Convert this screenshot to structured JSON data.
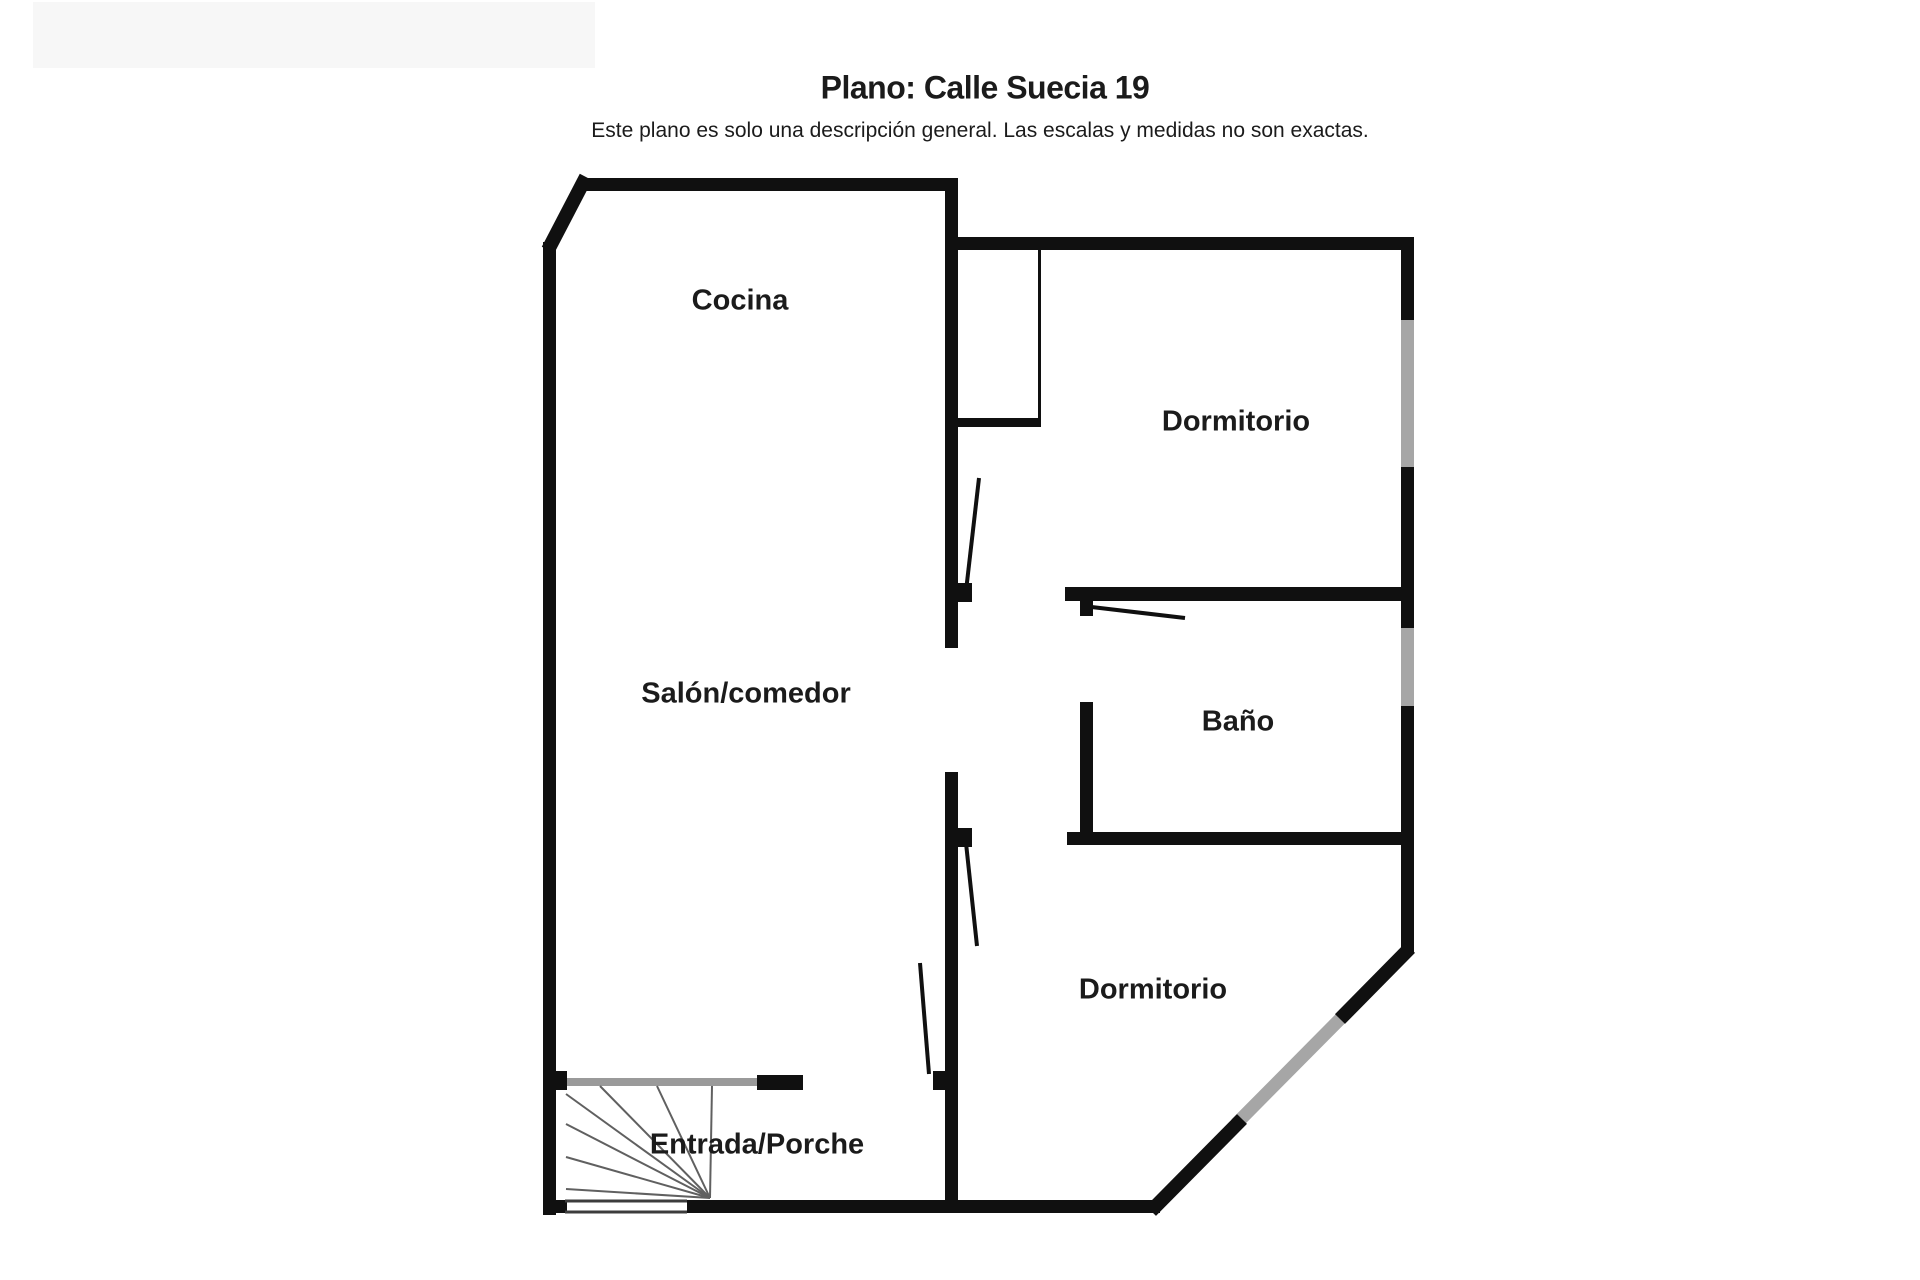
{
  "header": {
    "title": "Plano: Calle Suecia 19",
    "subtitle": "Este plano es solo una descripción general. Las escalas y medidas no son exactas.",
    "panel": {
      "x": 33,
      "y": 2,
      "w": 562,
      "h": 66
    }
  },
  "colors": {
    "wall": "#101010",
    "window": "#a6a6a6",
    "rail": "#9a9a9a",
    "sill": "#3c3c3c",
    "stair": "#606060",
    "panel": "#f7f7f7",
    "text": "#1b1b1b",
    "background": "#ffffff"
  },
  "rooms": [
    {
      "id": "cocina",
      "label": "Cocina",
      "x": 740,
      "y": 301
    },
    {
      "id": "salon-comedor",
      "label": "Salón/comedor",
      "x": 746,
      "y": 694
    },
    {
      "id": "dormitorio-1",
      "label": "Dormitorio",
      "x": 1236,
      "y": 422
    },
    {
      "id": "bano",
      "label": "Baño",
      "x": 1238,
      "y": 722
    },
    {
      "id": "dormitorio-2",
      "label": "Dormitorio",
      "x": 1153,
      "y": 990
    },
    {
      "id": "entrada-porche",
      "label": "Entrada/Porche",
      "x": 757,
      "y": 1145
    }
  ],
  "floorplan": {
    "width": 1920,
    "height": 1280,
    "rects": [
      {
        "name": "top-wall",
        "x": 580,
        "y": 178,
        "w": 378,
        "h": 13,
        "c": "wall"
      },
      {
        "name": "left-wall",
        "x": 543,
        "y": 242,
        "w": 13,
        "h": 973,
        "c": "wall"
      },
      {
        "name": "bottom-wall-left-corner",
        "x": 543,
        "y": 1200,
        "w": 24,
        "h": 13,
        "c": "wall"
      },
      {
        "name": "bottom-wall",
        "x": 687,
        "y": 1200,
        "w": 473,
        "h": 13,
        "c": "wall"
      },
      {
        "name": "right-wall-window-dormitorio1",
        "x": 1401,
        "y": 320,
        "w": 13,
        "h": 147,
        "c": "window"
      },
      {
        "name": "right-wall-window-bano",
        "x": 1401,
        "y": 628,
        "w": 13,
        "h": 78,
        "c": "window"
      },
      {
        "name": "right-wall-top",
        "x": 1401,
        "y": 240,
        "w": 13,
        "h": 80,
        "c": "wall"
      },
      {
        "name": "right-wall-mid",
        "x": 1401,
        "y": 467,
        "w": 13,
        "h": 161,
        "c": "wall"
      },
      {
        "name": "right-wall-bottom",
        "x": 1401,
        "y": 706,
        "w": 13,
        "h": 247,
        "c": "wall"
      },
      {
        "name": "dormitorio1-top-wall",
        "x": 945,
        "y": 237,
        "w": 469,
        "h": 13,
        "c": "wall"
      },
      {
        "name": "central-wall-upper",
        "x": 945,
        "y": 178,
        "w": 13,
        "h": 470,
        "c": "wall"
      },
      {
        "name": "central-wall-lower",
        "x": 945,
        "y": 772,
        "w": 13,
        "h": 441,
        "c": "wall"
      },
      {
        "name": "bano-top-wall",
        "x": 1065,
        "y": 587,
        "w": 349,
        "h": 14,
        "c": "wall"
      },
      {
        "name": "bano-left-wall",
        "x": 1080,
        "y": 702,
        "w": 13,
        "h": 143,
        "c": "wall"
      },
      {
        "name": "bano-bottom-wall",
        "x": 1067,
        "y": 832,
        "w": 347,
        "h": 13,
        "c": "wall"
      },
      {
        "name": "closet-bottom-wall",
        "x": 955,
        "y": 418,
        "w": 86,
        "h": 9,
        "c": "wall"
      },
      {
        "name": "closet-right-wall",
        "x": 1038,
        "y": 250,
        "w": 3,
        "h": 170,
        "c": "wall"
      },
      {
        "name": "porch-rail",
        "x": 563,
        "y": 1078,
        "w": 194,
        "h": 8,
        "c": "rail"
      },
      {
        "name": "porch-wall-segment",
        "x": 757,
        "y": 1075,
        "w": 46,
        "h": 15,
        "c": "wall"
      },
      {
        "name": "porch-rail-left-post",
        "x": 552,
        "y": 1071,
        "w": 15,
        "h": 19,
        "c": "wall"
      },
      {
        "name": "door-hinge-dormitorio1",
        "x": 958,
        "y": 583,
        "w": 14,
        "h": 19,
        "c": "wall"
      },
      {
        "name": "door-hinge-bano",
        "x": 1080,
        "y": 601,
        "w": 13,
        "h": 15,
        "c": "wall"
      },
      {
        "name": "door-hinge-dormitorio2",
        "x": 958,
        "y": 828,
        "w": 14,
        "h": 19,
        "c": "wall"
      },
      {
        "name": "door-hinge-entrance",
        "x": 933,
        "y": 1071,
        "w": 14,
        "h": 19,
        "c": "wall"
      }
    ],
    "lines": [
      {
        "name": "chamfer-wall",
        "x1": 586,
        "y1": 177,
        "x2": 548,
        "y2": 250,
        "w": 14,
        "c": "wall"
      },
      {
        "name": "diagonal-window",
        "x1": 1236,
        "y1": 1124,
        "x2": 1346,
        "y2": 1013,
        "w": 13,
        "c": "window"
      },
      {
        "name": "diagonal-wall-lower",
        "x1": 1151,
        "y1": 1211,
        "x2": 1242,
        "y2": 1119,
        "w": 14,
        "c": "wall"
      },
      {
        "name": "diagonal-wall-upper",
        "x1": 1340,
        "y1": 1019,
        "x2": 1410,
        "y2": 948,
        "w": 14,
        "c": "wall"
      },
      {
        "name": "entrance-opening-outer-line",
        "x1": 565,
        "y1": 1201,
        "x2": 687,
        "y2": 1201,
        "w": 3,
        "c": "sill"
      },
      {
        "name": "entrance-opening-inner-line",
        "x1": 565,
        "y1": 1212,
        "x2": 687,
        "y2": 1212,
        "w": 3,
        "c": "sill"
      },
      {
        "name": "door-leaf-dormitorio1",
        "x1": 966,
        "y1": 591,
        "x2": 979,
        "y2": 478,
        "w": 4,
        "c": "wall"
      },
      {
        "name": "door-leaf-bano",
        "x1": 1083,
        "y1": 606,
        "x2": 1185,
        "y2": 618,
        "w": 4,
        "c": "wall"
      },
      {
        "name": "door-leaf-dormitorio2",
        "x1": 966,
        "y1": 843,
        "x2": 977,
        "y2": 946,
        "w": 4,
        "c": "wall"
      },
      {
        "name": "door-leaf-entrance",
        "x1": 929,
        "y1": 1074,
        "x2": 920,
        "y2": 963,
        "w": 4,
        "c": "wall"
      }
    ],
    "stairs": {
      "apex": [
        710,
        1198
      ],
      "w": 2,
      "c": "stair",
      "targets": [
        [
          566,
          1094
        ],
        [
          566,
          1124
        ],
        [
          566,
          1157
        ],
        [
          566,
          1189
        ],
        [
          600,
          1086
        ],
        [
          657,
          1086
        ],
        [
          712,
          1086
        ]
      ]
    }
  }
}
